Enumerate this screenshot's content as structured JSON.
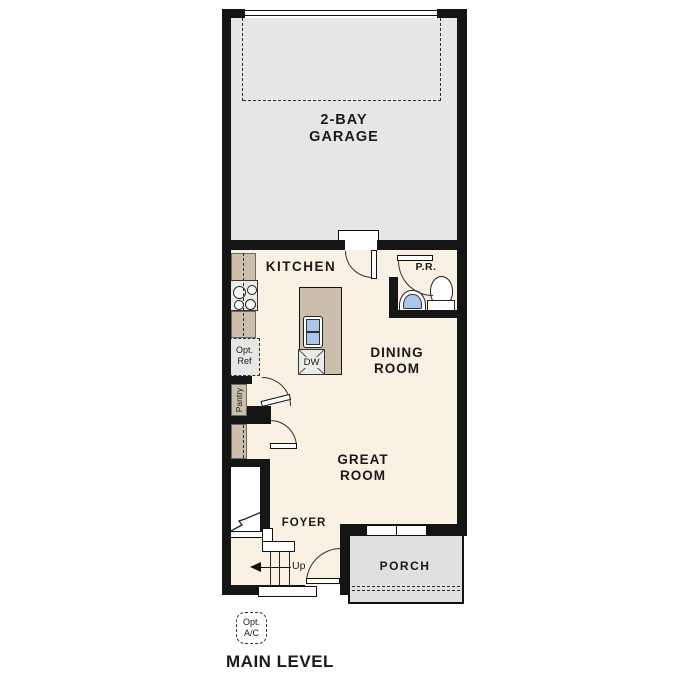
{
  "title": "MAIN LEVEL",
  "rooms": {
    "garage": {
      "line1": "2-BAY",
      "line2": "GARAGE"
    },
    "kitchen": {
      "label": "KITCHEN"
    },
    "powder_room": {
      "label": "P.R."
    },
    "dining": {
      "line1": "DINING",
      "line2": "ROOM"
    },
    "great": {
      "line1": "GREAT",
      "line2": "ROOM"
    },
    "foyer": {
      "label": "FOYER"
    },
    "porch": {
      "label": "PORCH"
    }
  },
  "annotations": {
    "stairs_up": "Up",
    "dishwasher": "DW",
    "opt_ref": {
      "line1": "Opt.",
      "line2": "Ref"
    },
    "pantry": "Pantry",
    "opt_ac": {
      "line1": "Opt.",
      "line2": "A/C"
    }
  },
  "colors": {
    "wall": "#151515",
    "garage_floor": "#e6e6e4",
    "interior_floor": "#f8f1e4",
    "counter_tan": "#cbbfab",
    "porch_gray": "#e0e0de",
    "sink_blue": "#a9c7e6",
    "text": "#1a1a1a"
  }
}
